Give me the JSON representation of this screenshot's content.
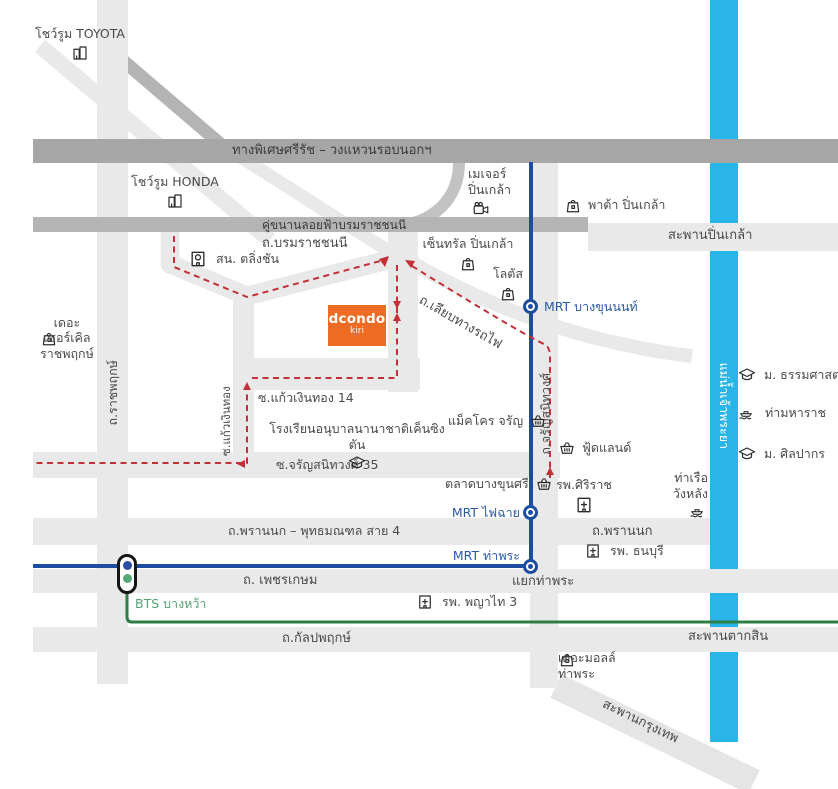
{
  "map_title": "dcondo kiri location map",
  "brand": {
    "name": "dcondo",
    "sub": "kiri"
  },
  "colors": {
    "accent_orange": "#EE6B24",
    "river_blue": "#29B5E8",
    "mrt_line_blue": "#1D4DA1",
    "mrt_label_blue": "#2C5AA8",
    "bts_line_green": "#2E7C46",
    "bts_label_green": "#56A275",
    "route_red": "#C23038",
    "road_light_gray": "#E9E9E9",
    "road_medium_gray": "#B4B4B4",
    "expressway_gray": "#A6A6A6",
    "text_gray": "#4A4A4A"
  },
  "roads": {
    "expressway": "ทางพิเศษศรีรัช – วงแหวนรอบนอกฯ",
    "kukanan_loifa": "คู่ขนานลอยฟ้าบรมราชชนนี",
    "borommaratchachonnani": "ถ.บรมราชชนนี",
    "saphan_pinklao": "สะพานปิ่นเกล้า",
    "liap_thang_rotfai": "ถ.เลียบทางรถไฟ",
    "ratchaphruek": "ถ.ราชพฤกษ์",
    "kaew_ngoen_thong": "ซ.แก้วเงินทอง",
    "kaew_ngoen_thong_14": "ซ.แก้วเงินทอง 14",
    "charansanitwong_35": "ซ.จรัญสนิทวงศ์ 35",
    "charansanitwong": "ถ.จรัญสนิทวงศ์",
    "phran_nok_phutthamonthon": "ถ.พรานนก – พุทธมณฑล สาย 4",
    "phran_nok": "ถ.พรานนก",
    "phetkasem": "ถ. เพชรเกษม",
    "kanlapaphruek": "ถ.กัลปพฤกษ์",
    "saphan_taksin": "สะพานตากสิน",
    "saphan_krungthep": "สะพานกรุงเทพ",
    "yaek_tha_phra": "แยกท่าพระ",
    "chao_phraya_river": "แม่น้ำเจ้าพระยา"
  },
  "transit": {
    "mrt_bang_khun_non": "MRT บางขุนนนท์",
    "mrt_fai_chai": "MRT ไฟฉาย",
    "mrt_tha_phra": "MRT ท่าพระ",
    "bts_bang_wa": "BTS บางหว้า"
  },
  "landmarks": {
    "toyota_showroom": {
      "label": "โชว์รูม TOYOTA",
      "icon": "building-icon"
    },
    "honda_showroom": {
      "label": "โชว์รูม HONDA",
      "icon": "building-icon"
    },
    "major_pinklao": {
      "line1": "เมเจอร์",
      "line2": "ปิ่นเกล้า",
      "icon": "cinema-icon"
    },
    "pata_pinklao": {
      "label": "พาต้า ปิ่นเกล้า",
      "icon": "shopping-bag-icon"
    },
    "central_pinklao": {
      "label": "เซ็นทรัล ปิ่นเกล้า",
      "icon": "shopping-bag-icon"
    },
    "lotus": {
      "label": "โลตัส",
      "icon": "shopping-bag-icon"
    },
    "taling_chan_police": {
      "label": "สน. ตลิ่งชัน",
      "icon": "police-station-icon"
    },
    "the_circle_ratchaphruek": {
      "line1": "เดอะ",
      "line2": "เซอร์เคิล",
      "line3": "ราชพฤกษ์",
      "icon": "shopping-bag-icon"
    },
    "kensington_kindergarten": {
      "label": "โรงเรียนอนุบาลนานาชาติเค็นซิงตัน",
      "icon": "school-icon"
    },
    "makro_charan": {
      "label": "แม็คโคร จรัญ",
      "icon": "market-basket-icon"
    },
    "foodland": {
      "label": "ฟู้ดแลนด์",
      "icon": "market-basket-icon"
    },
    "talad_bang_khun_si": {
      "label": "ตลาดบางขุนศรี",
      "icon": "market-basket-icon"
    },
    "siriraj_hospital": {
      "label": "รพ.ศิริราช",
      "icon": "hospital-icon"
    },
    "wang_lang_pier": {
      "line1": "ท่าเรือ",
      "line2": "วังหลัง",
      "icon": "pier-boat-icon"
    },
    "thammasat_university": {
      "label": "ม. ธรรมศาสตร์",
      "icon": "university-icon"
    },
    "tha_maharat": {
      "label": "ท่ามหาราช",
      "icon": "pier-boat-icon"
    },
    "silpakorn_university": {
      "label": "ม. ศิลปากร",
      "icon": "university-icon"
    },
    "thonburi_hospital": {
      "label": "รพ. ธนบุรี",
      "icon": "hospital-icon"
    },
    "phyathai_3_hospital": {
      "label": "รพ. พญาไท 3",
      "icon": "hospital-icon"
    },
    "the_mall_tha_phra": {
      "line1": "เดอะมอลล์",
      "line2": "ท่าพระ",
      "icon": "shopping-bag-icon"
    }
  }
}
